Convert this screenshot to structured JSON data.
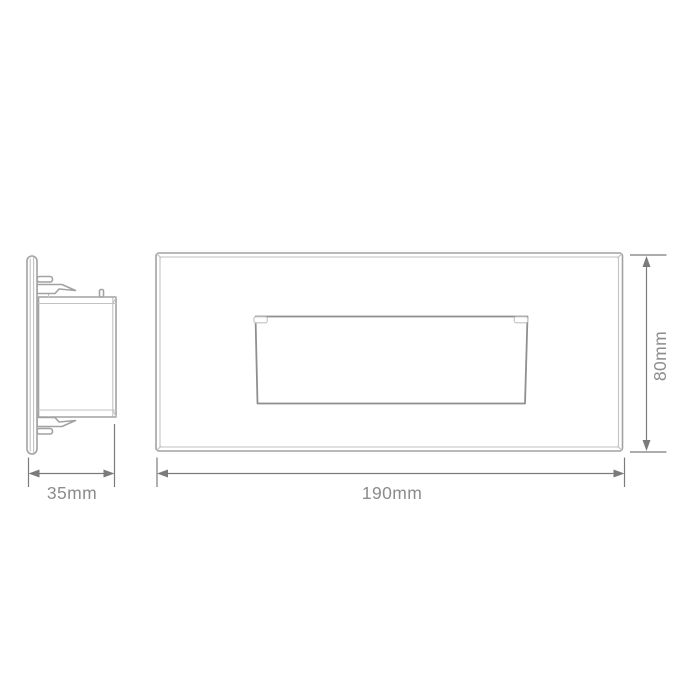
{
  "drawing": {
    "dimensions": {
      "side_depth": {
        "label": "35mm"
      },
      "front_width": {
        "label": "190mm"
      },
      "front_height": {
        "label": "80mm"
      }
    }
  },
  "colors": {
    "background": "#ffffff",
    "outline": "#a2a2a2",
    "outline_dark": "#8f8f8f",
    "outline_light": "#c2c2c2",
    "dimension_line": "#7b7b7b",
    "label_text": "#8c8c8c"
  }
}
